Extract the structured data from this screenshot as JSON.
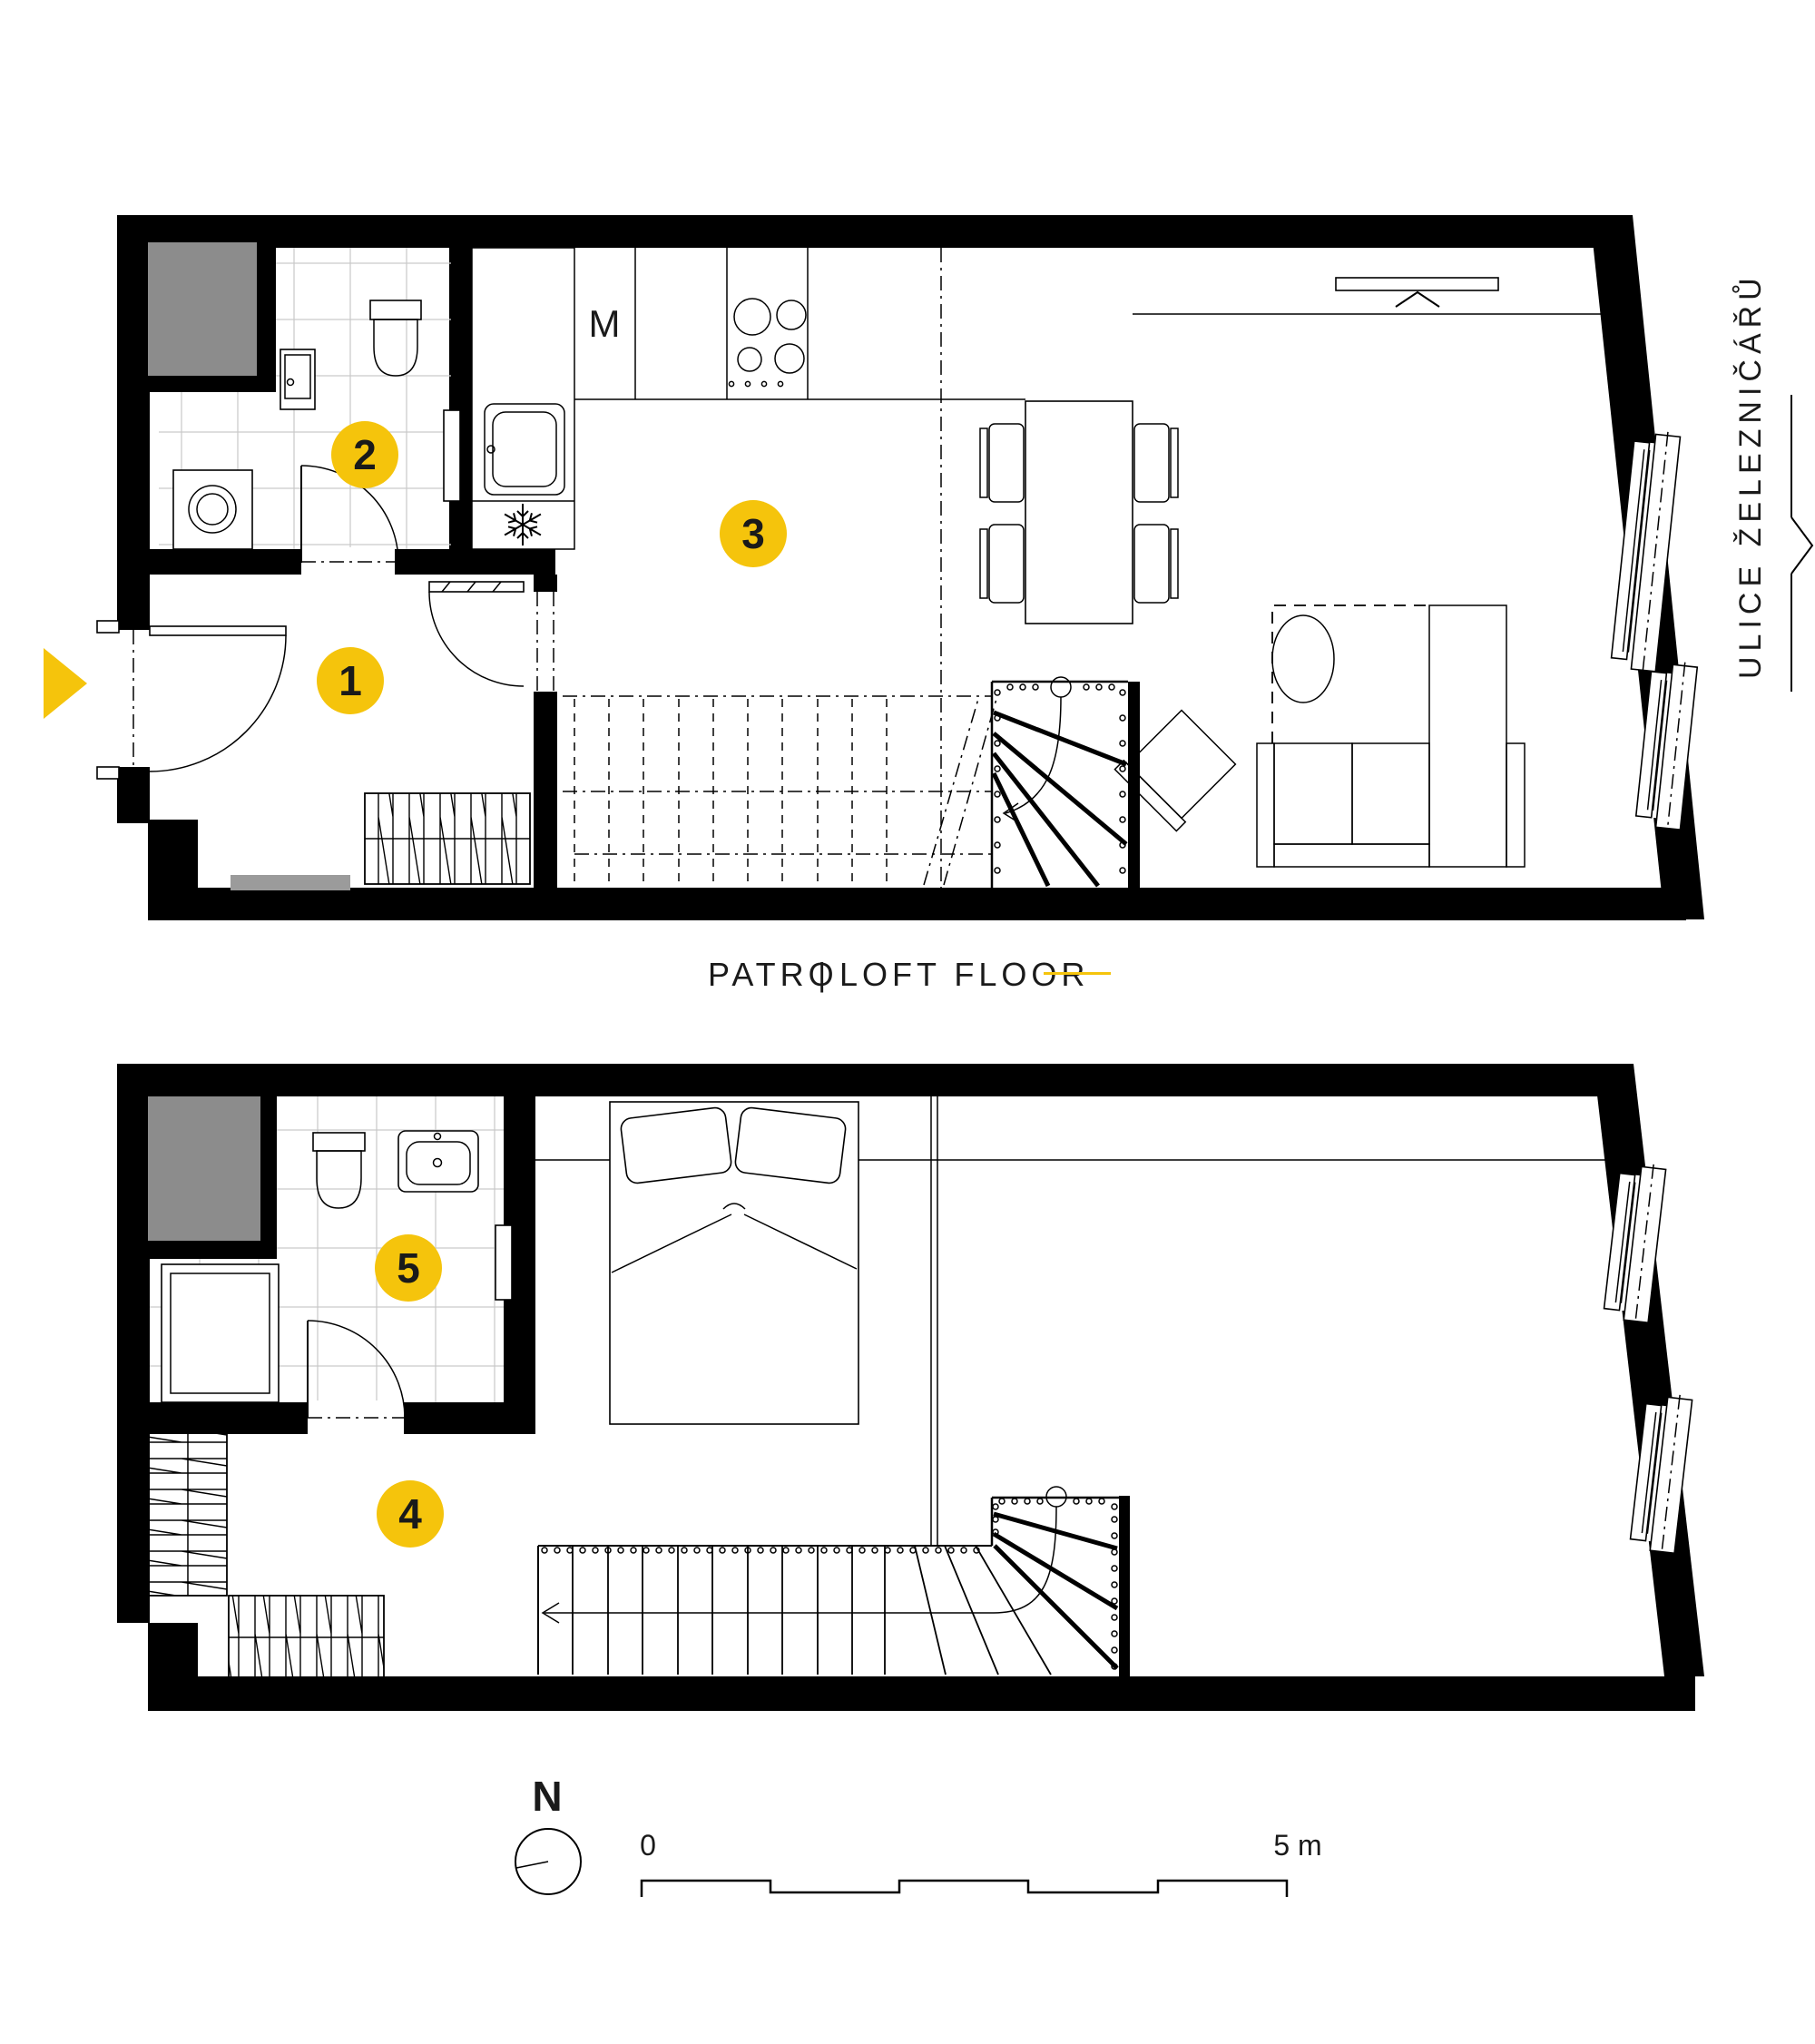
{
  "labels": {
    "floor_czech": "PATRO",
    "floor_divider": "|",
    "floor_english": "LOFT FLOOR",
    "street": "ULICE ŽELEZNIČÁŘŮ",
    "compass_north": "N",
    "scale_zero": "0",
    "scale_five_m": "5 m",
    "kitchen_appliance": "M"
  },
  "markers": [
    {
      "number": "1"
    },
    {
      "number": "2"
    },
    {
      "number": "3"
    },
    {
      "number": "4"
    },
    {
      "number": "5"
    }
  ],
  "colors": {
    "accent_yellow": "#F5C40C",
    "wall_black": "#000000",
    "shaft_gray": "#8C8C8C",
    "mat_gray": "#9B9B9B",
    "tile_grid": "#C9C9C9"
  }
}
